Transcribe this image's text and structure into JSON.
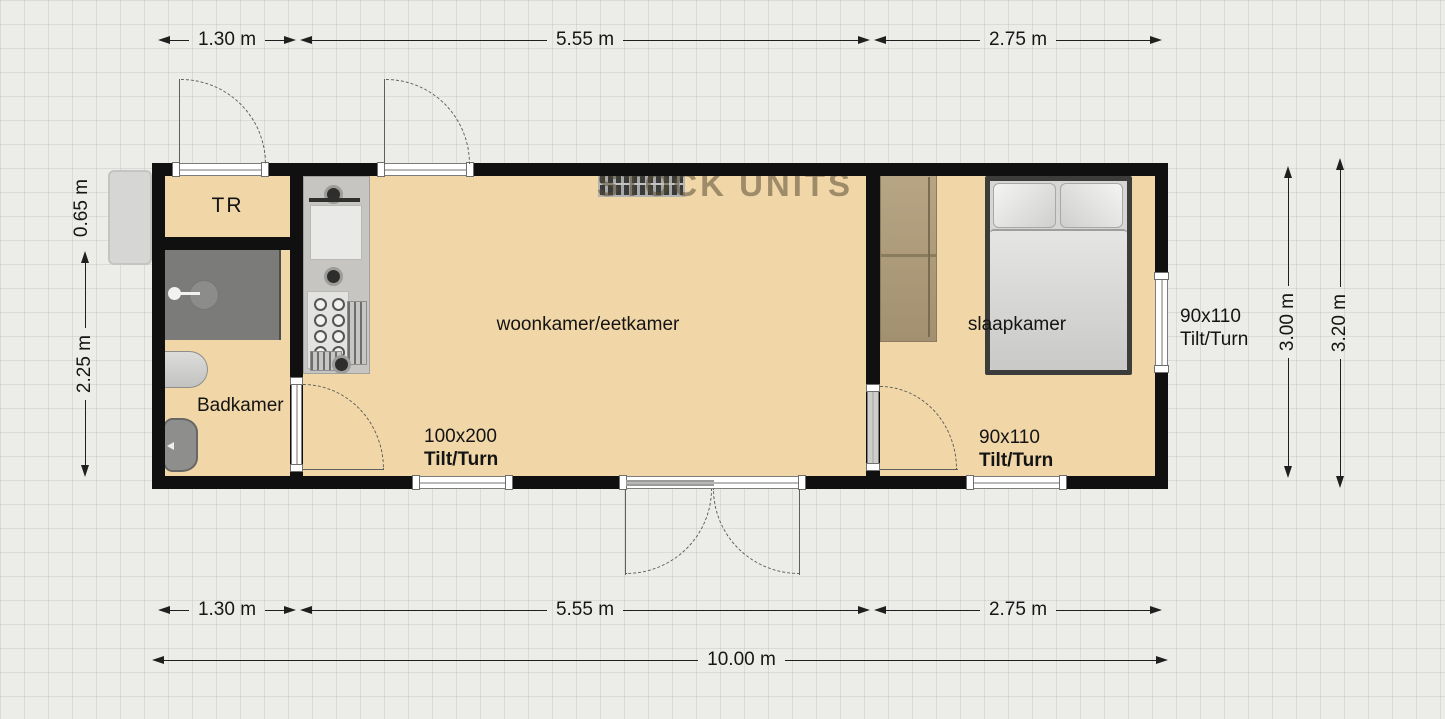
{
  "watermark": "STOCK UNITS",
  "rooms": {
    "tr": "TR",
    "bathroom": "Badkamer",
    "living": "woonkamer/eetkamer",
    "bedroom": "slaapkamer"
  },
  "windows": {
    "living_bottom": {
      "size": "100x200",
      "type": "Tilt/Turn"
    },
    "bedroom_bottom": {
      "size": "90x110",
      "type": "Tilt/Turn"
    },
    "bedroom_right": {
      "size": "90x110",
      "type": "Tilt/Turn"
    }
  },
  "dimensions": {
    "top": [
      "1.30 m",
      "5.55 m",
      "2.75 m"
    ],
    "bottom": [
      "1.30 m",
      "5.55 m",
      "2.75 m"
    ],
    "total": "10.00 m",
    "left": [
      "0.65 m",
      "2.25 m"
    ],
    "right": [
      "3.00 m",
      "3.20 m"
    ]
  },
  "colors": {
    "floor": "#f1d7a7",
    "wall": "#101010",
    "wood": "#b2a07e"
  }
}
